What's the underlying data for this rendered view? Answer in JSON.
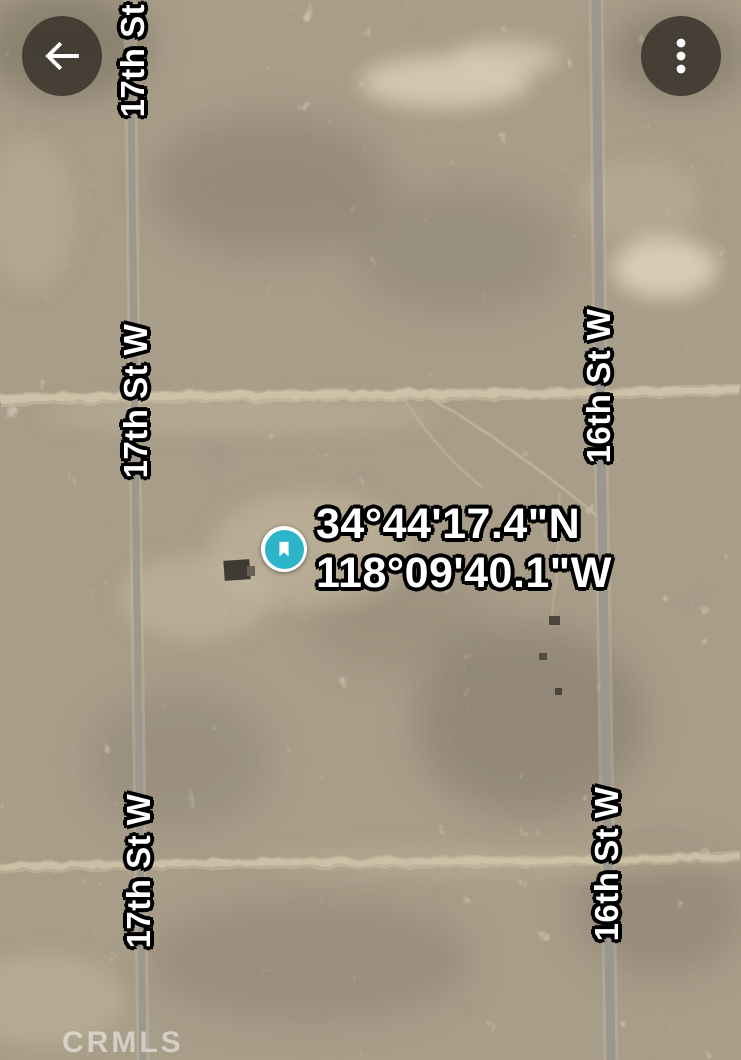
{
  "header": {
    "back_button": {
      "icon": "arrow-left-icon"
    },
    "menu_button": {
      "icon": "more-vert-icon"
    }
  },
  "map": {
    "view_type": "satellite",
    "coordinates": {
      "line1": "34°44'17.4\"N",
      "line2": "118°09'40.1\"W"
    },
    "roads": {
      "seventeenth": {
        "label": "17th St W"
      },
      "sixteenth": {
        "label": "16th St W"
      }
    },
    "marker": {
      "kind": "saved-place",
      "icon": "bookmark-icon",
      "color": "#2cb4c8"
    }
  },
  "watermark": {
    "text": "CRMLS"
  }
}
